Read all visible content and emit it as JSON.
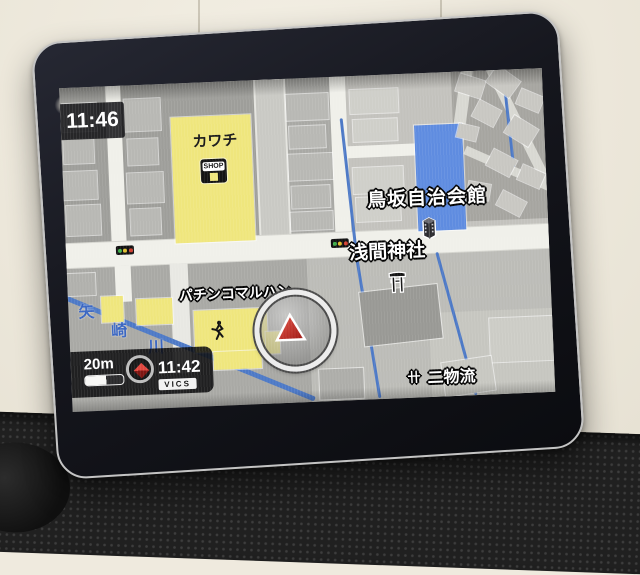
{
  "device": {
    "kind": "in-car navigation touchscreen",
    "clock_top": "11:46"
  },
  "map": {
    "poi_labels": {
      "kawachi_store": "カワチ",
      "shop_icon_text": "SHOP",
      "community_hall": "鳥坂自治会館",
      "shrine": "浅間神社",
      "pachinko": "パチンコマルハン",
      "bottom_right_partial_prefix": "卄",
      "bottom_right_partial": "二物流"
    },
    "river_name_chars": [
      "矢",
      "崎",
      "川"
    ],
    "icons": [
      "shop-icon",
      "traffic-light-icon",
      "building-3d-icon",
      "torii-shrine-icon",
      "runner-icon",
      "car-position-arrow-icon",
      "vics-compass-icon"
    ],
    "colors": {
      "poi_building_yellow": "#efe67d",
      "highlighted_building_blue": "#5f8ce0",
      "road_white": "#f0f0ea",
      "map_base_gray": "#a9a9a5",
      "river_blue": "#4d79c6",
      "car_arrow_red": "#c62f2a"
    }
  },
  "status_bar": {
    "scale_label": "20m",
    "vics_time": "11:42",
    "vics_label": "VICS"
  }
}
